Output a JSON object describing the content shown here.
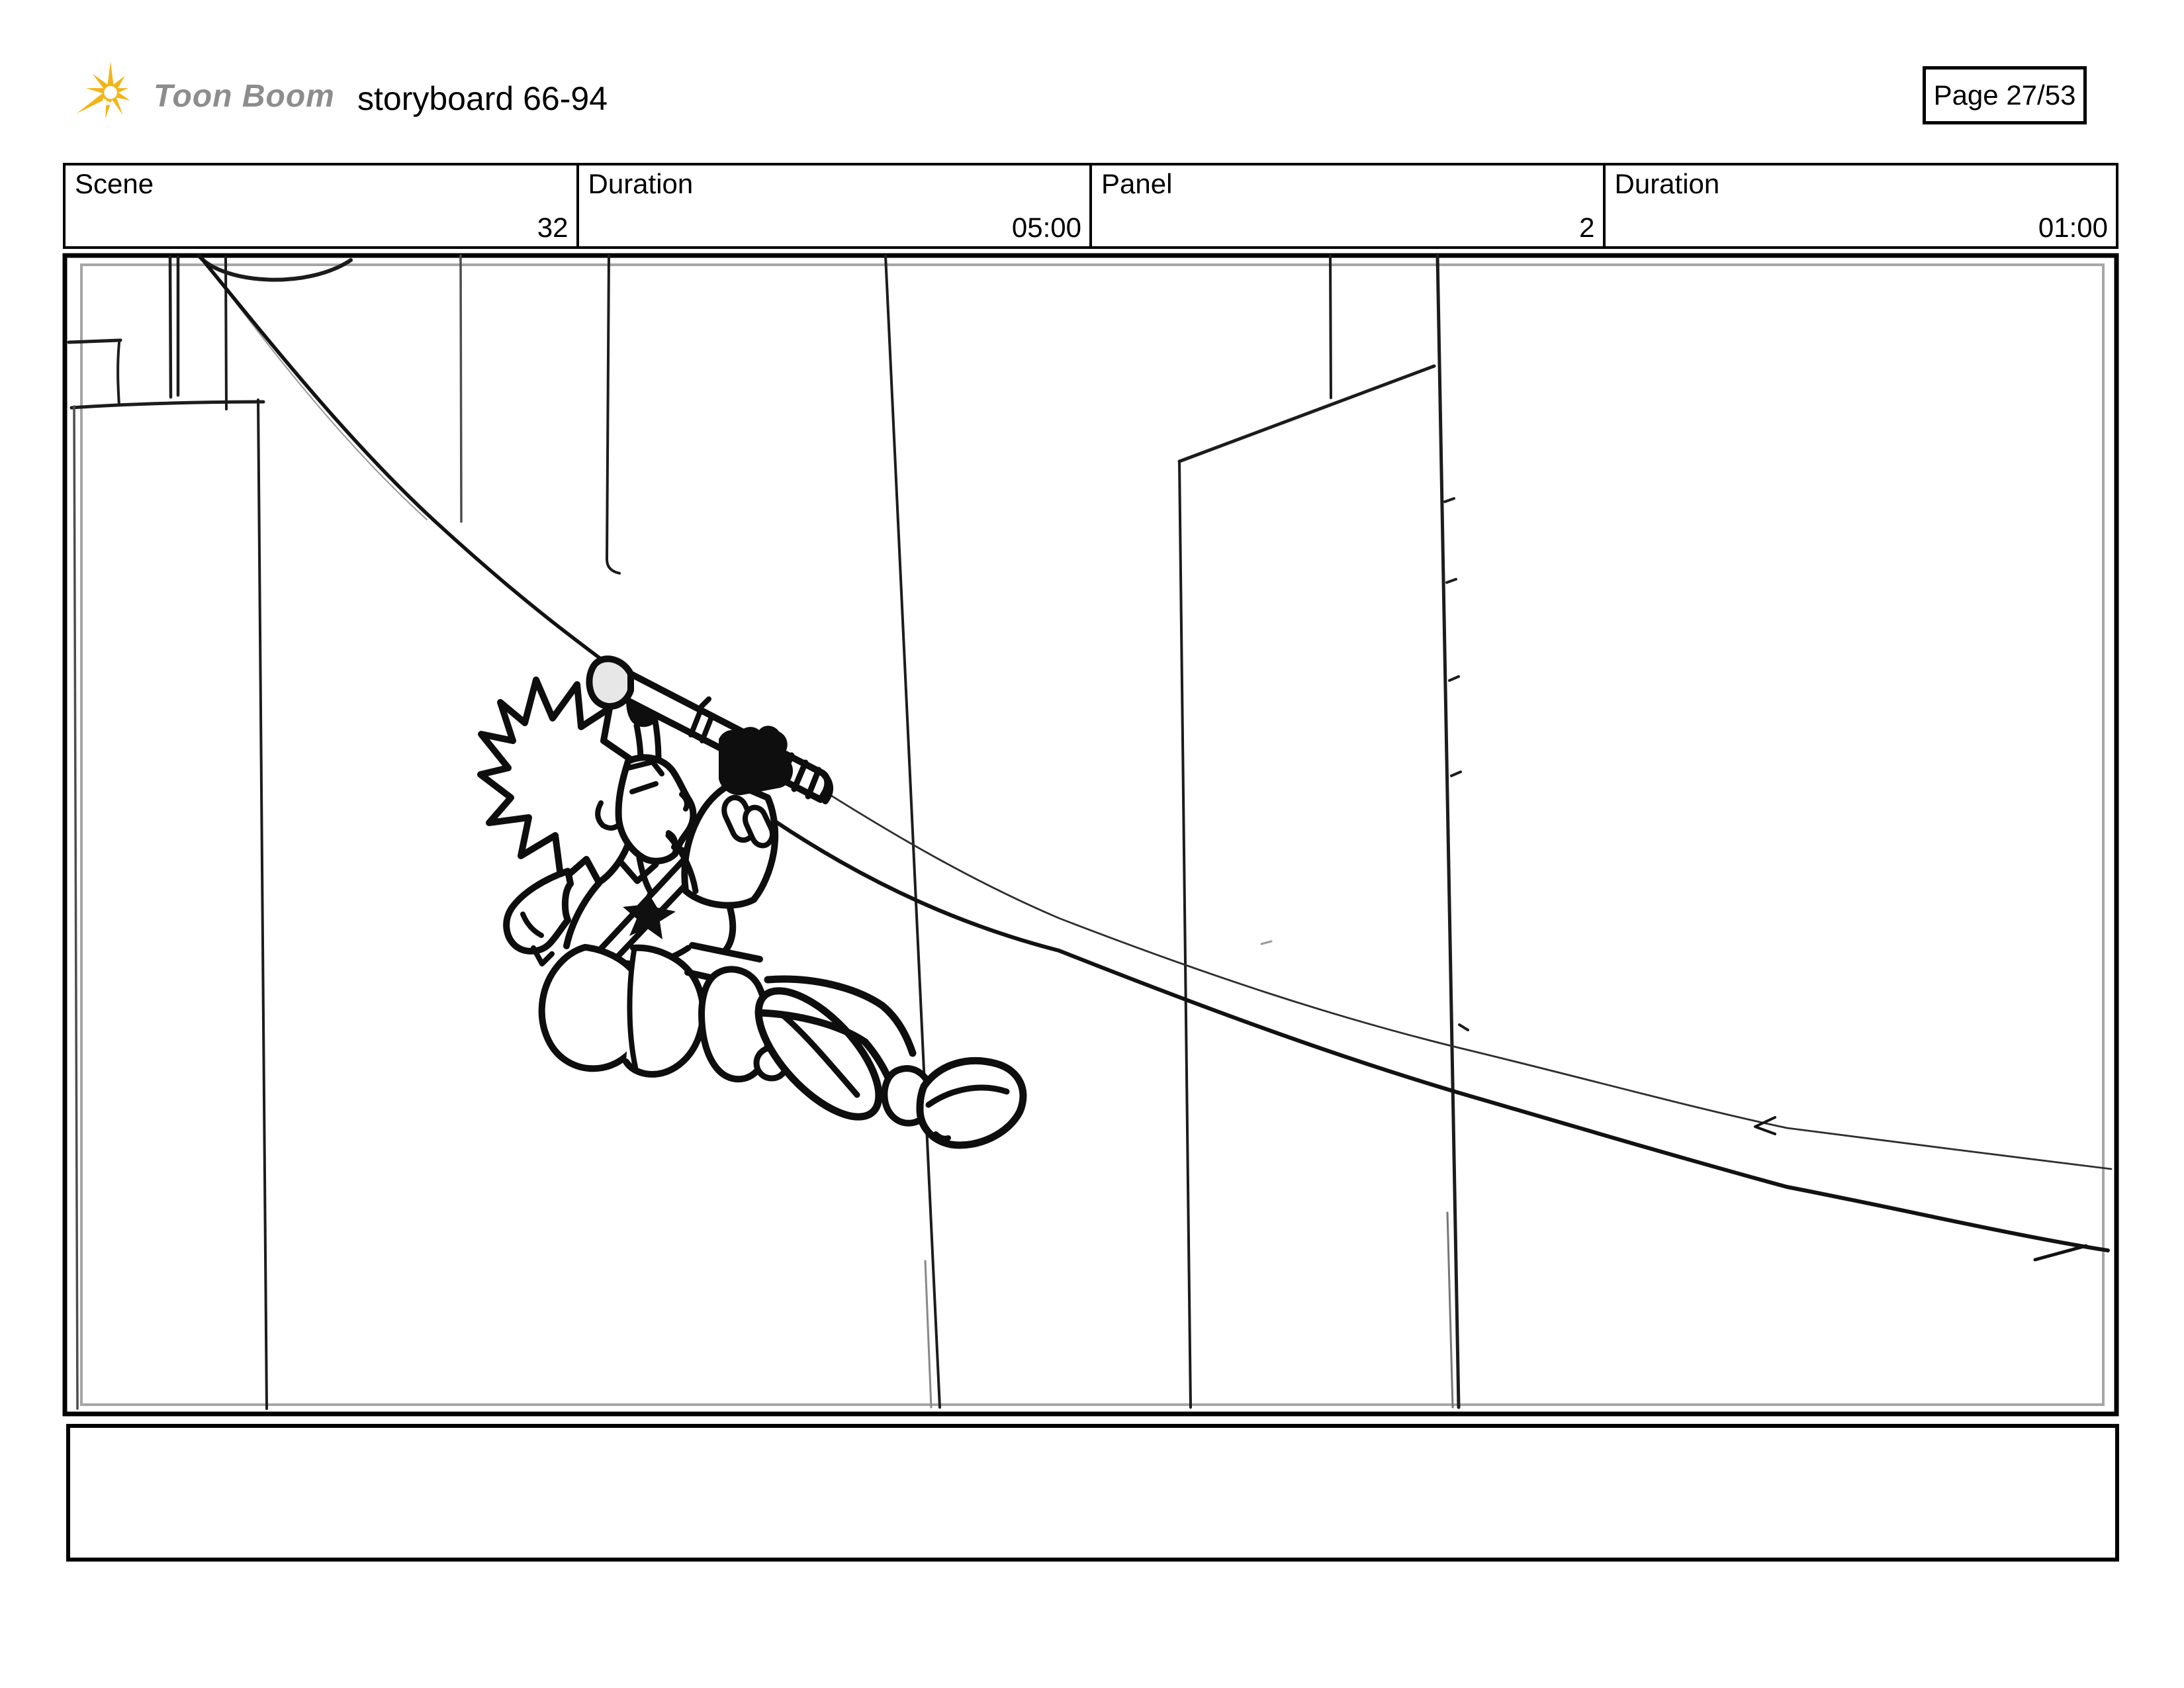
{
  "header": {
    "logo": {
      "wordmark": "Toon Boom"
    },
    "title": "storyboard 66-94",
    "page_label": "Page 27/53"
  },
  "info_table": {
    "cells": [
      {
        "label": "Scene",
        "value": "32"
      },
      {
        "label": "Duration",
        "value": "05:00"
      },
      {
        "label": "Panel",
        "value": "2"
      },
      {
        "label": "Duration",
        "value": "01:00"
      }
    ]
  },
  "panel": {
    "caption_text": ""
  },
  "colors": {
    "logo_yellow": "#F2B418",
    "logo_text_gray": "#8D8D8D",
    "ink_black": "#101010",
    "inner_border_gray": "#A6A6A6"
  }
}
